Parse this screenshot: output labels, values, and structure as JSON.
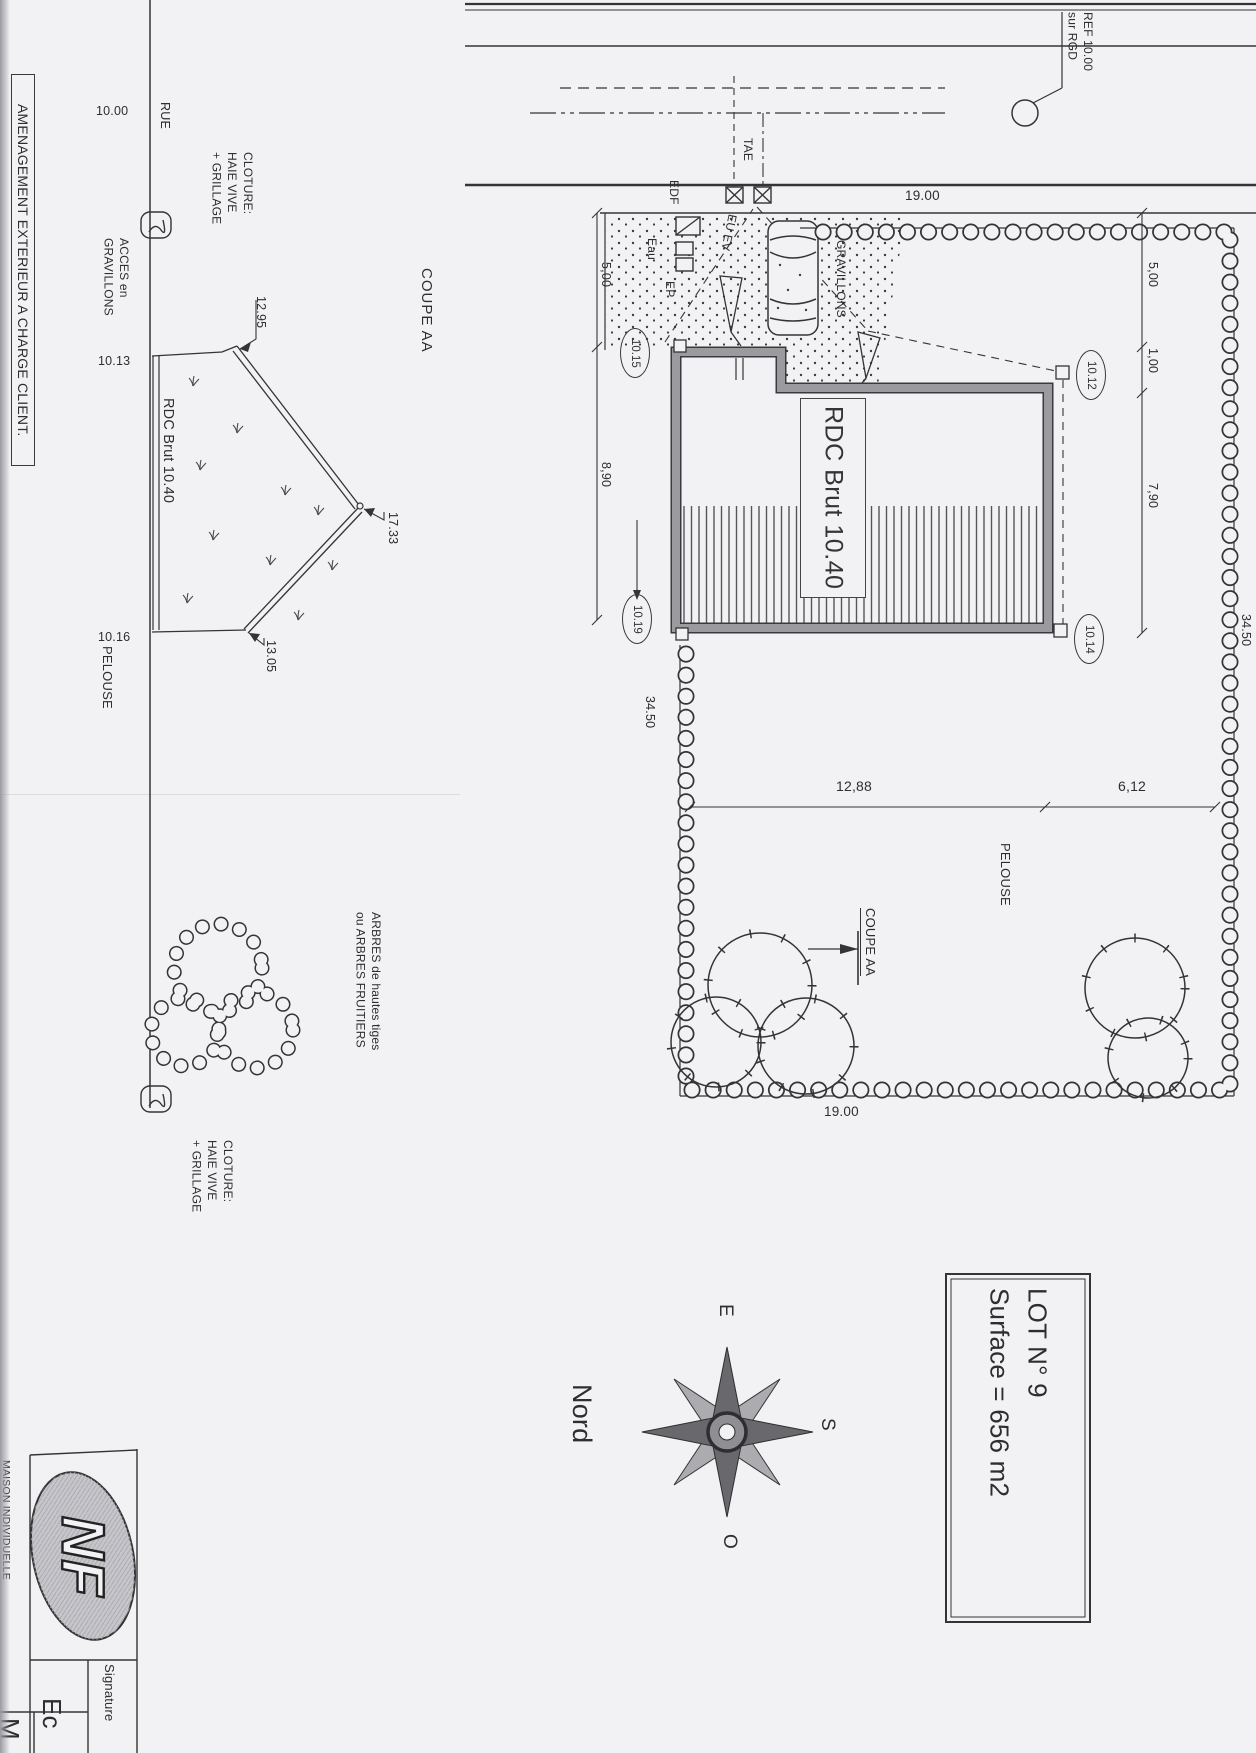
{
  "colors": {
    "paper": "#f2f2f4",
    "ink": "#343434",
    "wall_gray": "#95959a",
    "logo_gray": "#c7c7cb"
  },
  "margin_note": {
    "amenagement": "AMENAGEMENT EXTERIEUR A CHARGE CLIENT."
  },
  "street_ref": {
    "line1": "REF 10.00",
    "line2": "sur RGD"
  },
  "section": {
    "title": "COUPE AA",
    "street_width": "10.00",
    "street_name": "RUE",
    "fence_top": [
      "CLOTURE:",
      "HAIE VIVE",
      "+ GRILLAGE"
    ],
    "access": [
      "ACCES en",
      "GRAVILLONS"
    ],
    "level_top": "10.13",
    "eave_left": "12.95",
    "floor_label": "RDC Brut 10.40",
    "ridge": "17.33",
    "eave_right": "13.05",
    "level_bottom": "10.16",
    "lawn": "PELOUSE",
    "trees_note": [
      "ARBRES de hautes tiges",
      "ou ARBRES FRUITIERS"
    ],
    "fence_bottom": [
      "CLOTURE:",
      "HAIE VIVE",
      "+ GRILLAGE"
    ]
  },
  "plan": {
    "width_top": "19.00",
    "width_bottom": "19.00",
    "utilities": {
      "tae": "TAE",
      "edf": "EDF",
      "eau": "Eau",
      "eu_ev": "EU EV",
      "ep": "EP"
    },
    "gravel": "GRAVILLONS",
    "building_label": "RDC Brut 10.40",
    "dims_left": {
      "d1": "5,00",
      "d2": "8,90"
    },
    "dims_right": {
      "d1": "5,00",
      "d2": "1,00",
      "d3": "7,90"
    },
    "depth_left": "34.50",
    "depth_right": "34.50",
    "garden_dims": {
      "d1": "12,88",
      "d2": "6,12"
    },
    "spots": {
      "s1": "10.15",
      "s2": "10.19",
      "s3": "10.12",
      "s4": "10.14"
    },
    "lawn": "PELOUSE",
    "section_mark": "COUPE AA"
  },
  "compass": {
    "north": "Nord",
    "east": "E",
    "south": "S",
    "west": "O"
  },
  "lot": {
    "line1": "LOT N° 9",
    "line2": "Surface = 656 m2"
  },
  "title_block": {
    "logo": "NF",
    "org": "MAISON INDIVIDUELLE",
    "signature": "Signature",
    "ec": "Ec",
    "m": "M"
  },
  "icons": {
    "compass": "compass-rose-icon",
    "logo": "nf-certification-logo",
    "hedge": "hedge-ring-boundary",
    "tree": "tree-canopy-symbol",
    "car": "car-plan-icon",
    "utility_box": "crossed-utility-box-icon"
  }
}
